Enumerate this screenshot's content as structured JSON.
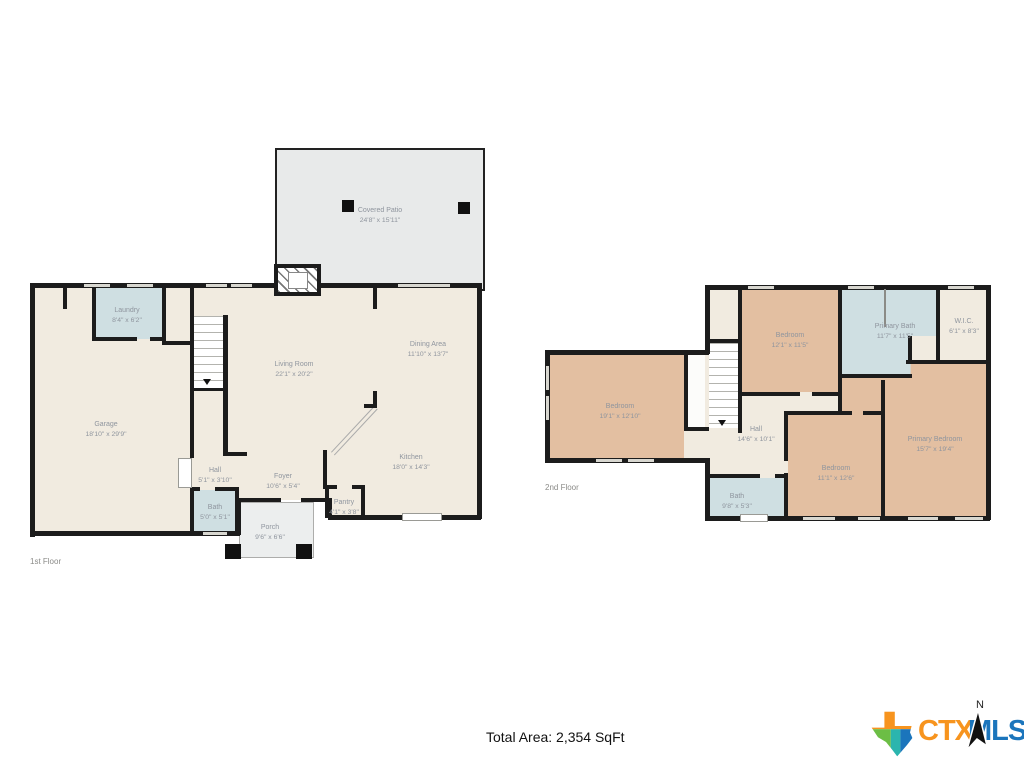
{
  "footer": {
    "total_area": "Total Area: 2,354 SqFt"
  },
  "logo": {
    "ctx": "CTX",
    "mls": "MLS",
    "north": "N"
  },
  "colors": {
    "wall": "#1c1c1c",
    "floor": "#f1ebe0",
    "wet_room": "#cfdfe2",
    "bedroom": "#e3bfa1",
    "outdoor": "#e8eaea",
    "label": "#8f959e",
    "ctx_orange": "#F7941E",
    "mls_blue": "#1B75BC"
  },
  "floor1": {
    "label": "1st Floor",
    "rooms": [
      {
        "name": "Covered Patio",
        "dims": "24'8\" x 15'11\""
      },
      {
        "name": "Laundry",
        "dims": "8'4\" x 6'2\""
      },
      {
        "name": "Garage",
        "dims": "18'10\" x 29'9\""
      },
      {
        "name": "Living Room",
        "dims": "22'1\" x 20'2\""
      },
      {
        "name": "Dining Area",
        "dims": "11'10\" x 13'7\""
      },
      {
        "name": "Kitchen",
        "dims": "18'0\" x 14'3\""
      },
      {
        "name": "Hall",
        "dims": "5'1\" x 3'10\""
      },
      {
        "name": "Foyer",
        "dims": "10'6\" x 5'4\""
      },
      {
        "name": "Bath",
        "dims": "5'0\" x 5'1\""
      },
      {
        "name": "Pantry",
        "dims": "4'1\" x 3'8\""
      },
      {
        "name": "Porch",
        "dims": "9'6\" x 6'6\""
      }
    ]
  },
  "floor2": {
    "label": "2nd Floor",
    "rooms": [
      {
        "name": "Bedroom",
        "dims": "12'1\" x 11'5\""
      },
      {
        "name": "Primary Bath",
        "dims": "11'7\" x 11'5\""
      },
      {
        "name": "W.I.C.",
        "dims": "6'1\" x 8'3\""
      },
      {
        "name": "Bedroom",
        "dims": "19'1\" x 12'10\""
      },
      {
        "name": "Hall",
        "dims": "14'6\" x 10'1\""
      },
      {
        "name": "Bedroom",
        "dims": "11'1\" x 12'6\""
      },
      {
        "name": "Primary Bedroom",
        "dims": "15'7\" x 19'4\""
      },
      {
        "name": "Bath",
        "dims": "9'8\" x 5'3\""
      }
    ]
  }
}
